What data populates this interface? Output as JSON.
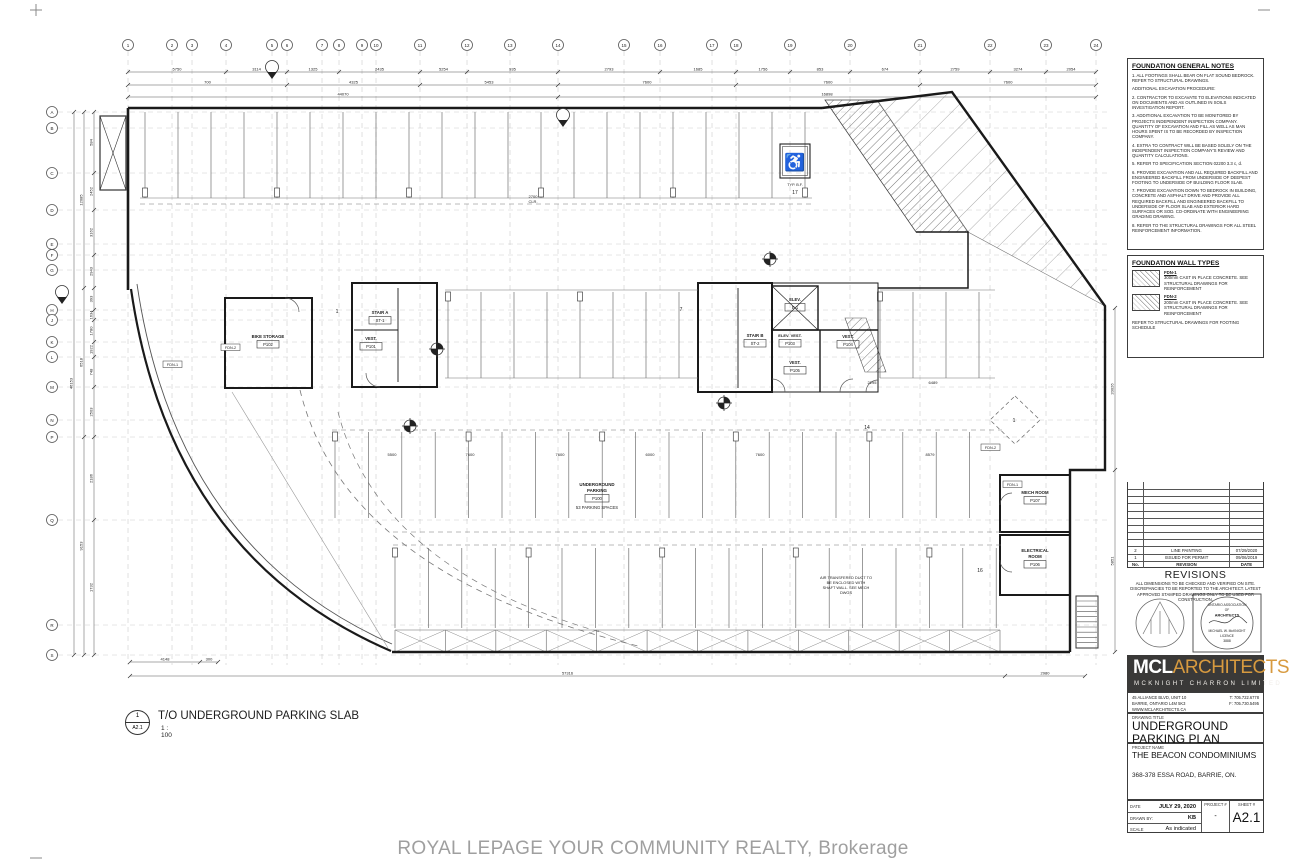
{
  "sheet": {
    "watermark": "ROYAL LEPAGE YOUR COMMUNITY REALTY, Brokerage"
  },
  "view": {
    "detail_number": "1",
    "detail_sheet": "A2.1",
    "title": "T/O UNDERGROUND PARKING SLAB",
    "scale": "1 : 100"
  },
  "icons": {
    "wheelchair": "♿"
  },
  "plan": {
    "parking_room": {
      "line1": "UNDERGROUND",
      "line2": "PARKING",
      "tag": "P100",
      "spaces": "53 PARKING SPACES"
    },
    "rooms": {
      "bike_storage": {
        "name": "BIKE STORAGE",
        "tag": "P102"
      },
      "stair_a": {
        "name": "STAIR A",
        "tag": "ST-1"
      },
      "vest_a": {
        "name": "VEST.",
        "tag": "P101"
      },
      "stair_b": {
        "name": "STAIR B",
        "tag": "ST-2"
      },
      "elevator": {
        "name": "ELEV.",
        "tag": "E-1"
      },
      "elev_vest": {
        "name": "ELEV. VEST.",
        "tag": "P103"
      },
      "vest_b": {
        "name": "VEST.",
        "tag": "P104"
      },
      "vest_c": {
        "name": "VEST.",
        "tag": "P105"
      },
      "mech": {
        "name": "MECH ROOM",
        "tag": "P107"
      },
      "electrical": {
        "name1": "ELECTRICAL",
        "name2": "ROOM",
        "tag": "P106"
      }
    },
    "notes": {
      "shaft": [
        "AIR TRANSFERED DUCT TO",
        "BE ENCLOSED WITH",
        "SHAFT WALL. SEE MECH",
        "DWGS"
      ],
      "clr1": "2700",
      "clr2": "CLR.",
      "typ_bf": "TYP. B.F."
    },
    "counts": {
      "c17": "17",
      "c7": "7",
      "c1": "1",
      "c14": "14",
      "c16": "16",
      "diamond": "1"
    },
    "wall_tags": [
      "FDN-1",
      "FDN-2",
      "FDN-2",
      "FDN-1"
    ],
    "grid_top": [
      "1",
      "2",
      "3",
      "4",
      "5",
      "6",
      "7",
      "8",
      "9",
      "10",
      "11",
      "12",
      "13",
      "14",
      "15",
      "16",
      "17",
      "18",
      "19",
      "20",
      "21",
      "22",
      "23",
      "24"
    ],
    "grid_left": [
      "A",
      "B",
      "C",
      "D",
      "E",
      "F",
      "G",
      "H",
      "J",
      "K",
      "L",
      "M",
      "N",
      "P",
      "Q",
      "R",
      "S"
    ],
    "dims": {
      "top1": [
        "5750",
        "3114",
        "1325",
        "2435",
        "5254",
        "935",
        "2793",
        "1685",
        "1756",
        "853",
        "674",
        "2759",
        "3274",
        "2054"
      ],
      "top2": [
        "700",
        "4325",
        "5453",
        "7600",
        "7600",
        "7600"
      ],
      "top3": [
        "44070",
        "16898"
      ],
      "left1": [
        "584",
        "2452",
        "3162",
        "2943",
        "393",
        "1634",
        "1780",
        "1922",
        "748",
        "2503",
        "2186",
        "1732"
      ],
      "left2": [
        "12085",
        "6518",
        "9153"
      ],
      "left3": [
        "46153"
      ],
      "bottom1": [
        "4148",
        "300"
      ],
      "bottom2": [
        "57316",
        "2980"
      ],
      "right1": [
        "20026",
        "5851"
      ],
      "interior": [
        "5500",
        "7600",
        "7600",
        "6000",
        "7600",
        "8579",
        "2295",
        "6489"
      ]
    }
  },
  "titleblock": {
    "general_notes": {
      "title": "FOUNDATION GENERAL NOTES",
      "items": [
        "1.  ALL FOOTINGS SHALL BEAR ON FLAT SOUND BEDROCK. REFER TO STRUCTURAL DRAWINGS.",
        "ADDITIONAL EXCAVATION PROCEDURE:",
        "2.  CONTRACTOR TO EXCAVATE TO ELEVATIONS INDICATED ON DOCUMENTS AND AS OUTLINED IN SOILS INVESTIGATION REPORT.",
        "3.  ADDITIONAL EXCAVATION TO BE MONITORED BY PROJECTS INDEPENDENT INSPECTION COMPANY. QUANTITY OF EXCAVATION AND FILL AS WELL AS MAN HOURS SPENT IS TO BE RECORDED BY INSPECTION COMPANY.",
        "4.  EXTRA TO CONTRACT WILL BE BASED SOLELY ON THE INDEPENDENT INSPECTION COMPANY'S REVIEW AND QUANTITY CALCULATIONS.",
        "5.  REFER TO SPECIFICATION SECTION 02200 3.3 c, d.",
        "6.  PROVIDE EXCAVATION AND ALL REQUIRED BACKFILL AND ENGINEERED BACKFILL FROM UNDERSIDE OF DEEPEST FOOTING TO UNDERSIDE OF BUILDING FLOOR SLAB.",
        "7.  PROVIDE EXCAVATION DOWN TO BEDROCK IN BUILDING, CONCRETE AND ASPHALT DRIVE AND PROVIDE ALL REQUIRED BACKFILL AND ENGINEERED BACKFILL TO UNDERSIDE OF FLOOR SLAB AND EXTERIOR HARD SURFACES OR SOD. CO-ORDINATE WITH ENGINEERING GRADING DRAWING.",
        "8.  REFER TO THE STRUCTURAL DRAWINGS FOR ALL STEEL REINFORCEMENT INFORMATION."
      ]
    },
    "wall_types": {
      "title": "FOUNDATION WALL TYPES",
      "types": [
        {
          "tag": "FDN-1",
          "desc": "300mm CAST IN PLACE CONCRETE. SEE STRUCTURAL DRAWINGS FOR REINFORCEMENT"
        },
        {
          "tag": "FDN-2",
          "desc": "200mm CAST IN PLACE CONCRETE. SEE STRUCTURAL DRAWINGS FOR REINFORCEMENT"
        }
      ],
      "footer": "REFER TO STRUCTURAL DRAWINGS FOR FOOTING SCHEDULE"
    },
    "revisions": {
      "title": "REVISIONS",
      "header": {
        "no": "No.",
        "revision": "REVISION",
        "date": "DATE"
      },
      "rows": [
        {
          "no": "2",
          "revision": "LINE PAINTING",
          "date": "07/29/2020"
        },
        {
          "no": "1",
          "revision": "ISSUED FOR PERMIT",
          "date": "09/06/2019"
        }
      ],
      "disclaimer": "ALL DIMENSIONS TO BE CHECKED AND VERIFIED ON SITE. DISCREPANCIES TO BE REPORTED TO THE ARCHITECT. LATEST APPROVED STAMPED DRAWINGS ONLY TO BE USED FOR CONSTRUCTION."
    },
    "stamp": {
      "assoc1": "ONTARIO ASSOCIATION",
      "assoc2": "OF",
      "assoc3": "ARCHITECTS",
      "architect": "MICHAEL W. McKNIGHT",
      "licence_label": "LICENCE",
      "licence_no": "3888"
    },
    "firm": {
      "name_bold": "MCL",
      "name_light": "ARCHITECTS",
      "name_sub": "MCKNIGHT CHARRON LIMITED",
      "address1": "45 ALLIANCE BLVD, UNIT 10",
      "address2": "BARRIE, ONTARIO  L4M 5K3",
      "address3": "WWW.MCLARCHITECTS.CA",
      "phone": "T: 705.722.6778",
      "fax": "F: 705.730.5495"
    },
    "drawing": {
      "title_label": "DRAWING TITLE",
      "title": "UNDERGROUND PARKING PLAN",
      "project_label": "PROJECT NAME",
      "project": "THE BEACON CONDOMINIUMS",
      "project_address": "368-378 ESSA ROAD, BARRIE, ON.",
      "date_label": "DATE",
      "date": "JULY 29, 2020",
      "drawn_label": "DRAWN BY:",
      "drawn": "KB",
      "scale_label": "SCALE",
      "scale": "As indicated",
      "project_no_label": "PROJECT #",
      "project_no": "-",
      "sheet_label": "SHEET #",
      "sheet": "A2.1"
    }
  }
}
